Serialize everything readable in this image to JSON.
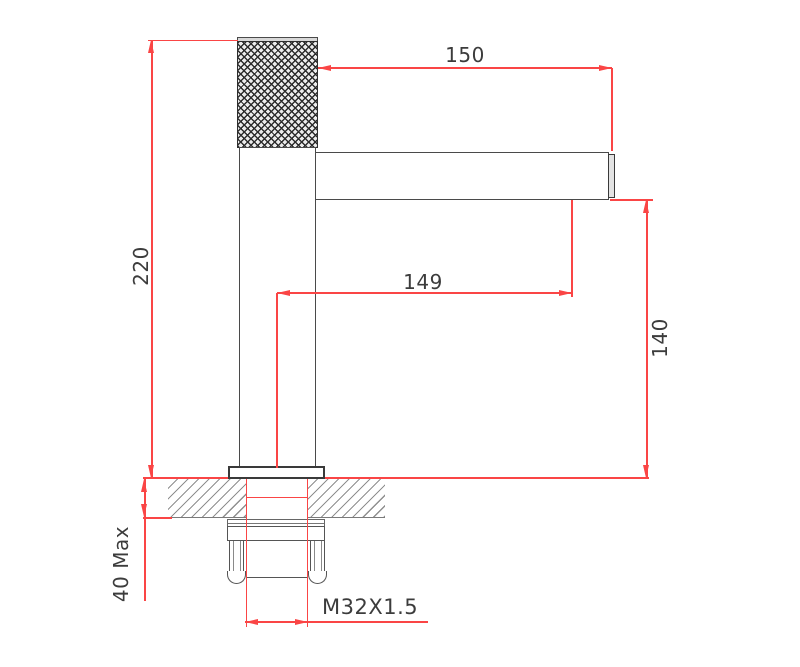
{
  "drawing": {
    "type": "technical-dimension-drawing",
    "subject": "basin-faucet-side-view"
  },
  "labels": {
    "spout_length_top": "150",
    "overall_height": "220",
    "outlet_reach": "149",
    "spout_height": "140",
    "deck_thickness": "40 Max",
    "thread_spec": "M32X1.5"
  },
  "colors": {
    "dimension_line": "#fa4545",
    "outline": "#4a4a4a",
    "label_text": "#3c3c3c",
    "hatch_line": "#8f8f8f"
  }
}
